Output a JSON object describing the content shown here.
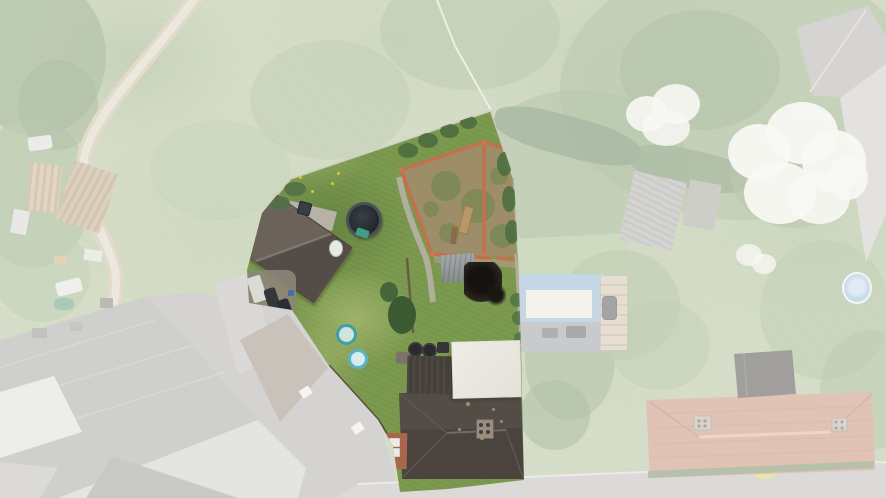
{
  "image_type": "aerial-drone-photo",
  "visible_features": [
    "highlighted-property-plot",
    "walled-kitchen-garden",
    "barn-outbuilding",
    "above-ground-pool",
    "garden-shed",
    "lawns",
    "paddling-pools",
    "dark-tiled-house-roof",
    "white-flat-roof",
    "junk-yard",
    "dirt-track",
    "allotment-clutter",
    "slate-roofs",
    "red-tiled-house",
    "blue-tarp",
    "patio",
    "blossom-trees",
    "hedges",
    "road"
  ],
  "palette": {
    "scrub_green": "#a9b98c",
    "tree_dark": "#5f7f4a",
    "hedge_dark": "#4f6e42",
    "track_tan": "#c3b394",
    "track_core": "#d9d0ba",
    "road_gray": "#b3b1ad",
    "roof_slate": "#9b9b97",
    "roof_red": "#be8263",
    "blossom_white": "#f2f1e9",
    "tarp_blue": "#87abc7",
    "cream": "#e7e4d9",
    "patio_gray": "#8f9192",
    "lawn": "#7c9a4f",
    "lawn_light": "#9cb47c",
    "soil": "#9d8d69",
    "brick": "#c2714e",
    "fence_gray": "#d4d2c8",
    "barn_roof": "#5a524b",
    "pool_rim": "#4a5055",
    "pool_water": "#23272c",
    "teal": "#3f9e86",
    "shed_gray": "#9aa1a1",
    "burn_dark": "#15120f",
    "white_roof": "#ece9e3",
    "house_dark": "#4b433d",
    "chimney": "#9a8c80",
    "paddle_blue": "#5ab4c4",
    "van_white": "#dadad6",
    "dandelion": "#dcc63e",
    "front_brick": "#a8664a"
  },
  "overlay": {
    "fade_color": "#ffffff",
    "fade_opacity": 0.52
  },
  "plot": {
    "polygon": [
      [
        491,
        110
      ],
      [
        514,
        178
      ],
      [
        518,
        254
      ],
      [
        521,
        346
      ],
      [
        524,
        480
      ],
      [
        448,
        489
      ],
      [
        400,
        492
      ],
      [
        393,
        446
      ],
      [
        378,
        420
      ],
      [
        329,
        366
      ],
      [
        292,
        310
      ],
      [
        249,
        303
      ],
      [
        247,
        270
      ],
      [
        262,
        213
      ],
      [
        291,
        178
      ]
    ]
  }
}
